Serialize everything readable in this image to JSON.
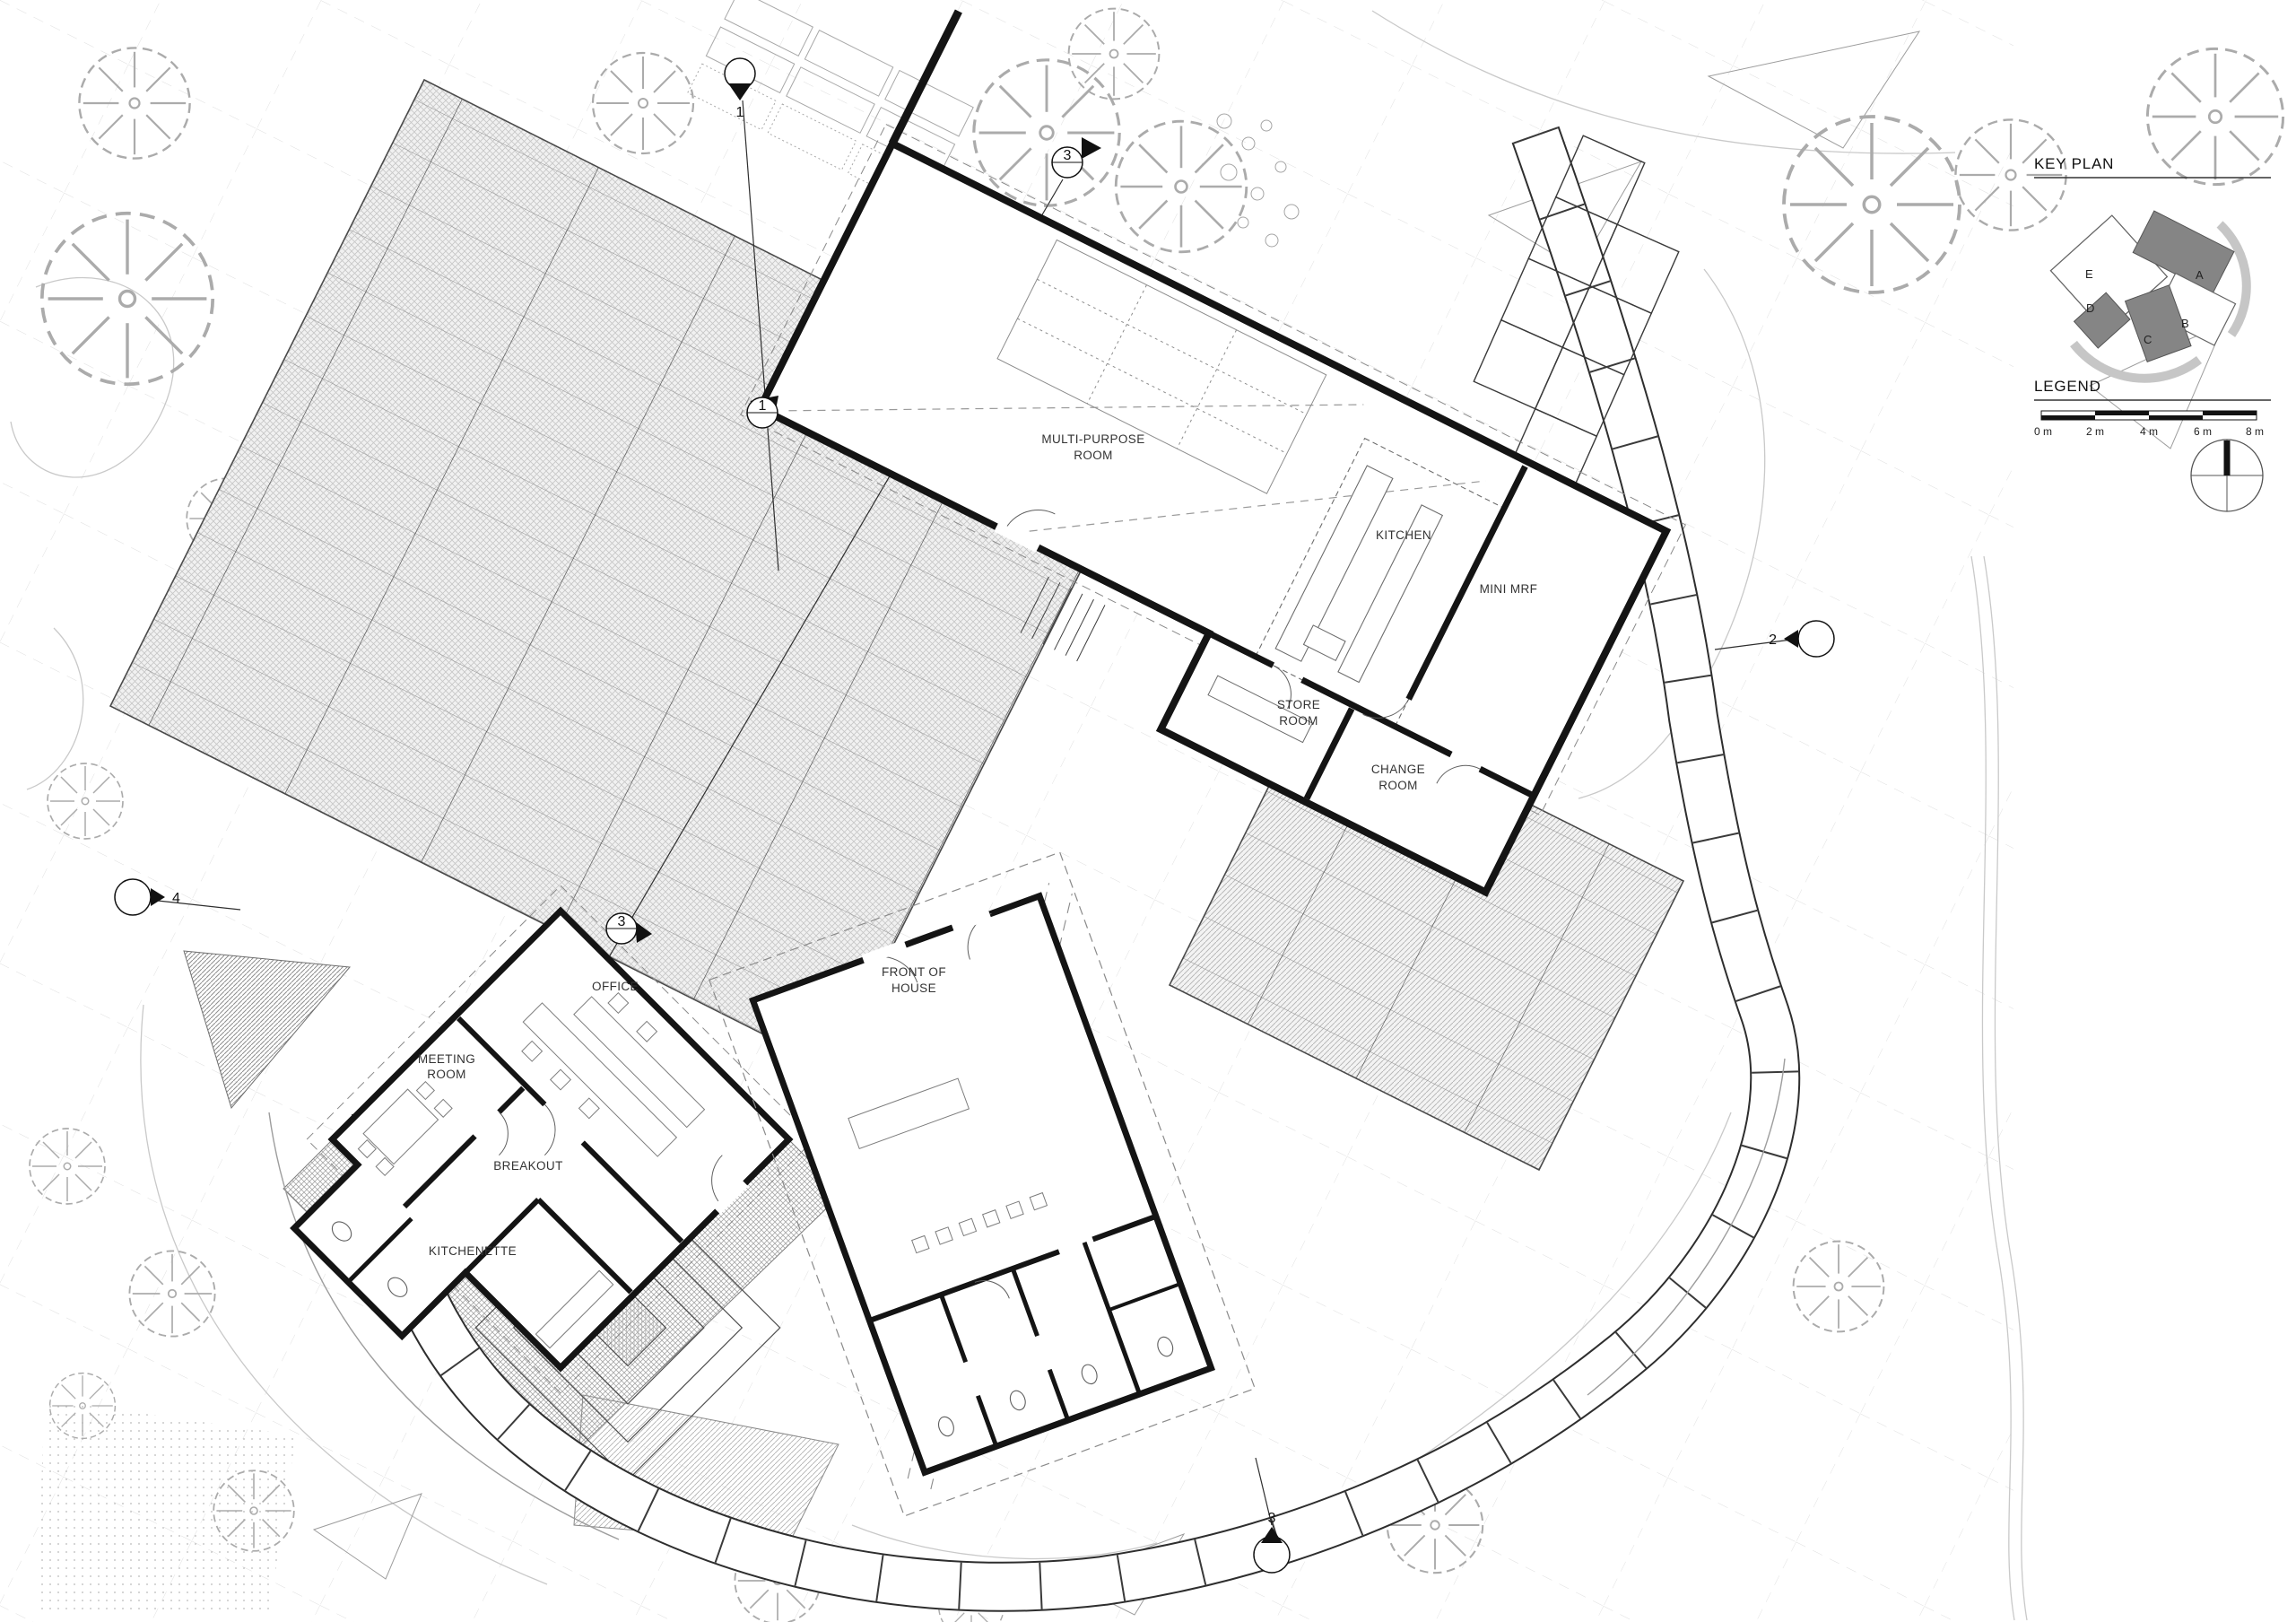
{
  "drawing": {
    "rooms": {
      "multi_purpose": {
        "line1": "MULTI-PURPOSE",
        "line2": "ROOM"
      },
      "kitchen": {
        "label": "KITCHEN"
      },
      "mini_mrf": {
        "label": "MINI MRF"
      },
      "store_room": {
        "line1": "STORE",
        "line2": "ROOM"
      },
      "change_room": {
        "line1": "CHANGE",
        "line2": "ROOM"
      },
      "office": {
        "label": "OFFICE"
      },
      "meeting_room": {
        "line1": "MEETING",
        "line2": "ROOM"
      },
      "breakout": {
        "label": "BREAKOUT"
      },
      "kitchenette": {
        "label": "KITCHENETTE"
      },
      "front_of_house": {
        "line1": "FRONT OF",
        "line2": "HOUSE"
      }
    },
    "section_markers": {
      "n1": "1",
      "n2": "2",
      "n3": "3",
      "n4": "4"
    }
  },
  "key_plan": {
    "title": "KEY PLAN",
    "labels": {
      "a": "A",
      "b": "B",
      "c": "C",
      "d": "D",
      "e": "E"
    }
  },
  "legend": {
    "title": "LEGEND",
    "scale": [
      "0 m",
      "2 m",
      "4 m",
      "6 m",
      "8 m"
    ]
  },
  "colors": {
    "wall": "#141414",
    "annotation": "#2b2b2b",
    "light_line": "#9a9a9a",
    "deck_hatch": "#c2c2c2",
    "keyplan_building_fill": "#858585",
    "keyplan_path_fill": "#c6c6c6",
    "background": "#ffffff"
  }
}
